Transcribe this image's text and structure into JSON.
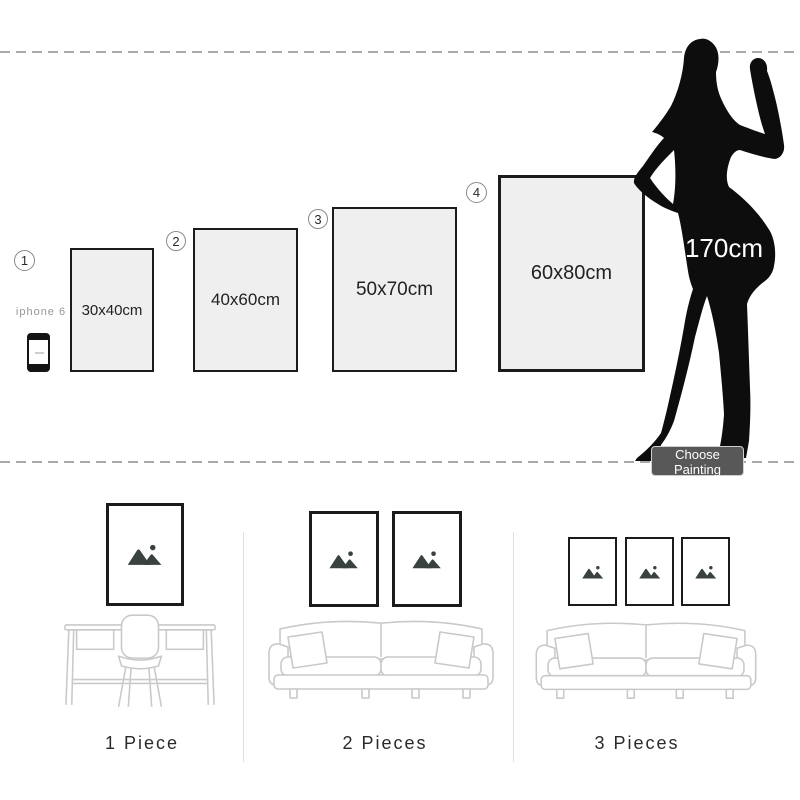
{
  "size_chart": {
    "frames": [
      {
        "number": "1",
        "size": "30x40cm"
      },
      {
        "number": "2",
        "size": "40x60cm"
      },
      {
        "number": "3",
        "size": "50x70cm"
      },
      {
        "number": "4",
        "size": "60x80cm"
      }
    ],
    "reference_phone": {
      "label": "iphone 6"
    },
    "model": {
      "height_label": "170cm"
    },
    "choose_button": {
      "label": "Choose Painting"
    }
  },
  "room_previews": {
    "items": [
      {
        "label": "1 Piece",
        "frame_count": 1,
        "furniture": "desk-and-chair"
      },
      {
        "label": "2 Pieces",
        "frame_count": 2,
        "furniture": "sofa"
      },
      {
        "label": "3 Pieces",
        "frame_count": 3,
        "furniture": "sofa"
      }
    ]
  },
  "colors": {
    "frame_border": "#1b1b1b",
    "frame_fill": "#efefef",
    "silhouette": "#0d0d0d",
    "button_bg": "#585858",
    "button_text": "#ffffff",
    "dashed_line": "#a9a9a9",
    "furniture_stroke": "#c9c9c9",
    "placeholder_icon": "#39423f"
  }
}
